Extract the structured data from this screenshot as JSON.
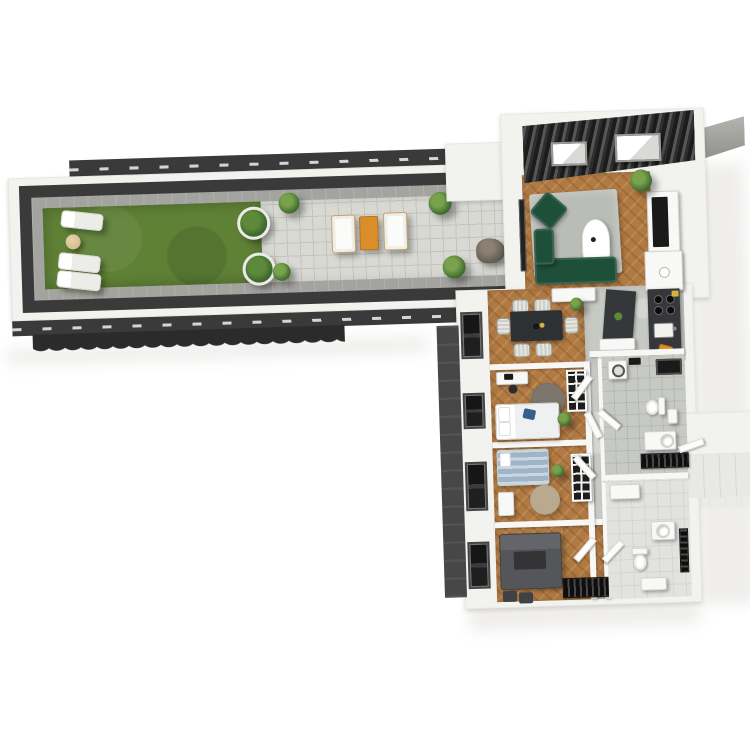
{
  "meta": {
    "image_type": "3d-architectural-floorplan-render",
    "view": "top-down isometric",
    "text_on_screen": "none"
  },
  "palette": {
    "bg": "#ffffff",
    "shadow_soft": "#efeeec",
    "wall_white": "#f2f2ef",
    "dark_band": "#3a3a3a",
    "dark_band2": "#2b2b2b",
    "facade_dark": "#474747",
    "concrete": "#a3a3a0",
    "lawn": "#5f8136",
    "patio_tile": "#d9d9d4",
    "patio_line": "#c4c4bf",
    "wood": "#b17a43",
    "rug_gray": "#b9bcb7",
    "sofa_green": "#1e4f39",
    "accent_orange": "#d98e2b",
    "white_furn": "#f8f8f6",
    "counter_dark": "#35373a",
    "tile_gray": "#c7c9c5",
    "tile_light": "#e2e2df",
    "window_dark": "#252525",
    "plant_green": "#3e6b2f",
    "plant_green2": "#5d8a3a",
    "bed_blue": "#9fb4c7",
    "rock_gray": "#6b6258",
    "beige": "#c9a06a",
    "dark_furn": "#54565a"
  },
  "scene": {
    "terrace": {
      "zones": [
        "lawn",
        "paved-patio"
      ],
      "items": [
        "sun-lounger x3",
        "round-side-table",
        "round-planter x2",
        "outdoor-sofa x2",
        "orange-coffee-table",
        "shrub x4",
        "boulder"
      ]
    },
    "apartment": {
      "rooms": [
        "living-room",
        "open-kitchen",
        "dining-area",
        "bedroom-1",
        "bedroom-2",
        "bedroom-3",
        "bathroom",
        "wc-bathroom",
        "hallway"
      ],
      "items": [
        "slatted-roof-with-skylights",
        "green-sofa",
        "green-armchair",
        "gray-rug",
        "oval-coffee-table",
        "tv-sideboard",
        "kitchen-island",
        "cooktop",
        "kitchen-sink",
        "dining-table-6-chairs",
        "beds x3",
        "round-rugs",
        "desks",
        "grid-shelves",
        "washing-machine",
        "shower",
        "toilets x2",
        "vanities",
        "radiators",
        "facade-windows x4",
        "entrance-walkway"
      ]
    }
  }
}
